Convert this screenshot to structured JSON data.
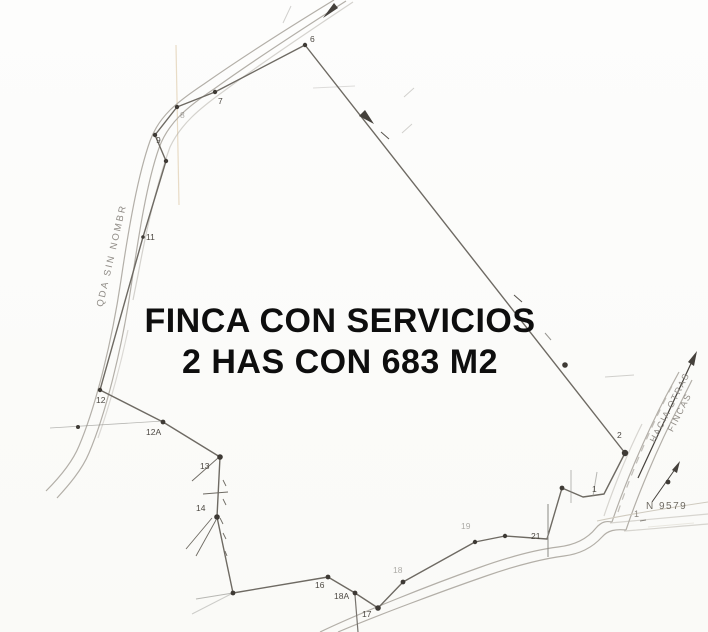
{
  "title": {
    "line1": "FINCA CON SERVICIOS",
    "line2": "2 HAS CON 683 M2"
  },
  "annotations": {
    "left_road_label": "QDA SIN NOMBR",
    "right_road_label_line1": "HACIA OTRAS",
    "right_road_label_line2": "FINCAS",
    "grid_line_label": "N 9579",
    "grid_line_tick": "1"
  },
  "colors": {
    "boundary_ink": "#6e6a63",
    "vertex_dot": "#3e3a35",
    "road_line": "#b3afa8",
    "label_ink": "#4c4842",
    "title_ink": "#0e0e0e",
    "fold_line": "#cdae7d"
  },
  "survey": {
    "boundary_points": [
      [
        305,
        45
      ],
      [
        215,
        92
      ],
      [
        177,
        107
      ],
      [
        155,
        135
      ],
      [
        166,
        161
      ],
      [
        143,
        237
      ],
      [
        100,
        390
      ],
      [
        163,
        422
      ],
      [
        220,
        457
      ],
      [
        217,
        517
      ],
      [
        233,
        593
      ],
      [
        328,
        577
      ],
      [
        355,
        593
      ],
      [
        378,
        608
      ],
      [
        403,
        582
      ],
      [
        475,
        542
      ],
      [
        505,
        536
      ],
      [
        547,
        539
      ],
      [
        562,
        488
      ],
      [
        583,
        497
      ],
      [
        604,
        494
      ],
      [
        625,
        453
      ],
      [
        305,
        45
      ]
    ],
    "vertex_dots": [
      [
        305,
        45,
        2.2
      ],
      [
        215,
        92,
        2.2
      ],
      [
        177,
        107,
        2.2
      ],
      [
        155,
        135,
        2.2
      ],
      [
        166,
        161,
        2.2
      ],
      [
        143,
        237,
        1.8
      ],
      [
        100,
        390,
        2.2
      ],
      [
        163,
        422,
        2.4
      ],
      [
        220,
        457,
        2.8
      ],
      [
        217,
        517,
        2.8
      ],
      [
        233,
        593,
        2.4
      ],
      [
        328,
        577,
        2.4
      ],
      [
        355,
        593,
        2.4
      ],
      [
        378,
        608,
        2.8
      ],
      [
        403,
        582,
        2.4
      ],
      [
        475,
        542,
        2.2
      ],
      [
        505,
        536,
        2.2
      ],
      [
        562,
        488,
        2.4
      ],
      [
        625,
        453,
        3.2
      ],
      [
        565,
        365,
        2.8
      ],
      [
        668,
        482,
        2.4
      ],
      [
        78,
        427,
        2.0
      ]
    ],
    "vertex_labels": [
      {
        "label": "6",
        "x": 310,
        "y": 34,
        "faint": false
      },
      {
        "label": "7",
        "x": 218,
        "y": 96,
        "faint": false
      },
      {
        "label": "8",
        "x": 180,
        "y": 110,
        "faint": true
      },
      {
        "label": "9",
        "x": 156,
        "y": 135,
        "faint": false
      },
      {
        "label": "11",
        "x": 146,
        "y": 232,
        "faint": false
      },
      {
        "label": "12",
        "x": 96,
        "y": 395,
        "faint": false
      },
      {
        "label": "12A",
        "x": 146,
        "y": 427,
        "faint": false
      },
      {
        "label": "13",
        "x": 200,
        "y": 461,
        "faint": false
      },
      {
        "label": "14",
        "x": 196,
        "y": 503,
        "faint": false
      },
      {
        "label": "16",
        "x": 315,
        "y": 580,
        "faint": false
      },
      {
        "label": "18A",
        "x": 334,
        "y": 591,
        "faint": false
      },
      {
        "label": "17",
        "x": 362,
        "y": 609,
        "faint": false
      },
      {
        "label": "18",
        "x": 393,
        "y": 565,
        "faint": true
      },
      {
        "label": "19",
        "x": 461,
        "y": 521,
        "faint": true
      },
      {
        "label": "21",
        "x": 531,
        "y": 531,
        "faint": false
      },
      {
        "label": "1",
        "x": 592,
        "y": 484,
        "faint": false
      },
      {
        "label": "2",
        "x": 617,
        "y": 430,
        "faint": false
      }
    ]
  }
}
